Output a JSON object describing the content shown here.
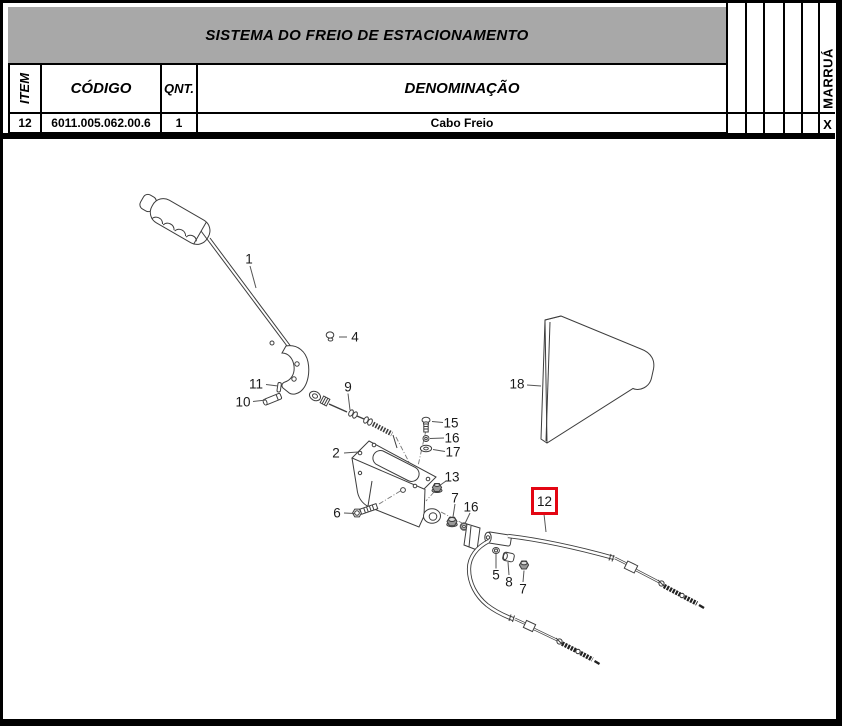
{
  "parts_table": {
    "title": "SISTEMA DO FREIO DE ESTACIONAMENTO",
    "headers": {
      "item": "ITEM",
      "code": "CÓDIGO",
      "qty": "QNT.",
      "description": "DENOMINAÇÃO"
    },
    "brand_column": "MARRUÁ",
    "rows": [
      {
        "item": "12",
        "code": "6011.005.062.00.6",
        "qty": "1",
        "description": "Cabo Freio",
        "marrua": "X"
      }
    ]
  },
  "colors": {
    "title_bg": "#a8a8a8",
    "highlight_red": "#e30613",
    "line": "#3d3d3d"
  },
  "diagram": {
    "highlighted_callout": "12",
    "callouts": {
      "c1": "1",
      "c2": "2",
      "c4": "4",
      "c5": "5",
      "c6": "6",
      "c7a": "7",
      "c7b": "7",
      "c8": "8",
      "c9": "9",
      "c10": "10",
      "c11": "11",
      "c12": "12",
      "c13": "13",
      "c15": "15",
      "c16a": "16",
      "c16b": "16",
      "c17": "17",
      "c18": "18"
    }
  }
}
